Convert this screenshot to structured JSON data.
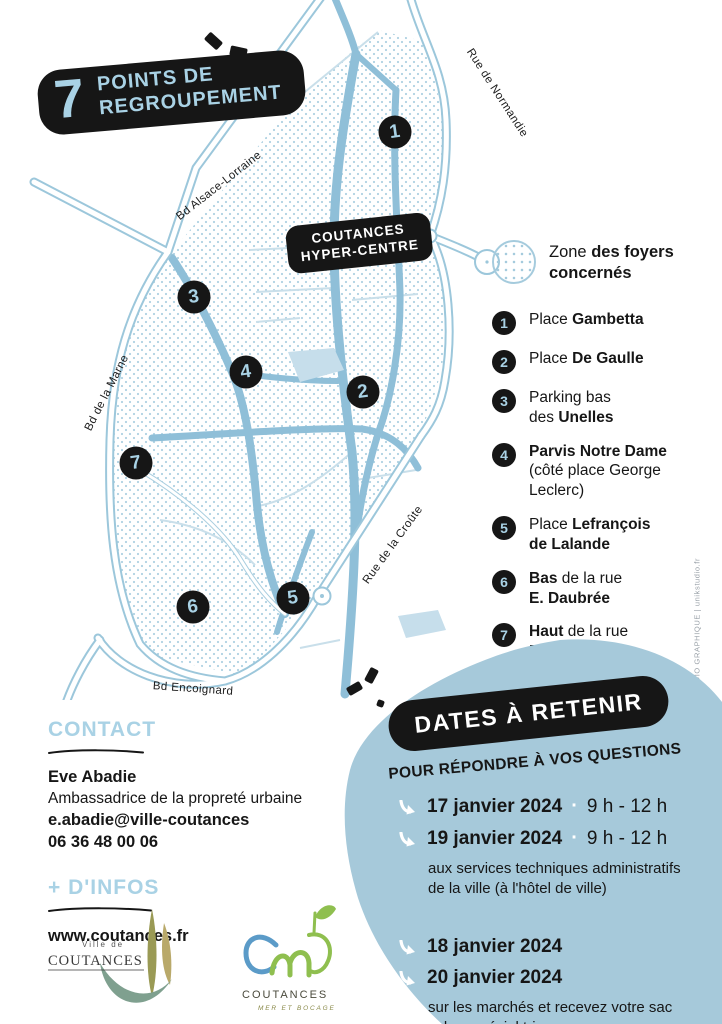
{
  "title": {
    "number": "7",
    "line1": "POINTS DE",
    "line2": "REGROUPEMENT"
  },
  "map": {
    "badge_line1": "COUTANCES",
    "badge_line2": "HYPER-CENTRE",
    "streets": [
      {
        "label": "Bd Alsace-Lorraine"
      },
      {
        "label": "Rue de Normandie"
      },
      {
        "label": "Bd de la Marne"
      },
      {
        "label": "Rue de la Croûte"
      },
      {
        "label": "Bd Encoignard"
      }
    ],
    "markers": [
      {
        "n": "1"
      },
      {
        "n": "2"
      },
      {
        "n": "3"
      },
      {
        "n": "4"
      },
      {
        "n": "5"
      },
      {
        "n": "6"
      },
      {
        "n": "7"
      }
    ]
  },
  "legend": {
    "zone_label": [
      {
        "t": "Zone "
      },
      {
        "t": "des foyers",
        "b": true
      },
      {
        "br": true
      },
      {
        "t": "concernés",
        "b": true
      }
    ],
    "items": [
      {
        "num": "1",
        "text": [
          {
            "t": "Place "
          },
          {
            "t": "Gambetta",
            "b": true
          }
        ]
      },
      {
        "num": "2",
        "text": [
          {
            "t": "Place "
          },
          {
            "t": "De Gaulle",
            "b": true
          }
        ]
      },
      {
        "num": "3",
        "text": [
          {
            "t": "Parking bas"
          },
          {
            "br": true
          },
          {
            "t": "des "
          },
          {
            "t": "Unelles",
            "b": true
          }
        ]
      },
      {
        "num": "4",
        "text": [
          {
            "t": "Parvis Notre Dame",
            "b": true
          },
          {
            "br": true
          },
          {
            "t": "(côté place George"
          },
          {
            "br": true
          },
          {
            "t": "Leclerc)"
          }
        ]
      },
      {
        "num": "5",
        "text": [
          {
            "t": "Place "
          },
          {
            "t": "Lefrançois",
            "b": true
          },
          {
            "br": true
          },
          {
            "t": "de Lalande",
            "b": true
          }
        ]
      },
      {
        "num": "6",
        "text": [
          {
            "t": "Bas",
            "b": true
          },
          {
            "t": " de la rue"
          },
          {
            "br": true
          },
          {
            "t": "E. Daubrée",
            "b": true
          }
        ]
      },
      {
        "num": "7",
        "text": [
          {
            "t": "Haut",
            "b": true
          },
          {
            "t": " de la rue"
          },
          {
            "br": true
          },
          {
            "t": "E. Daubrée",
            "b": true
          }
        ]
      }
    ]
  },
  "dates": {
    "badge": "DATES À RETENIR",
    "subtitle": "POUR RÉPONDRE À VOS QUESTIONS",
    "group1_rows": [
      {
        "date": "17 janvier 2024",
        "sep": "·",
        "time": "9 h - 12 h"
      },
      {
        "date": "19 janvier 2024",
        "sep": "·",
        "time": "9 h - 12 h"
      }
    ],
    "group1_note1": "aux services techniques administratifs",
    "group1_note2": "de la ville (à l'hôtel de ville)",
    "group2_rows": [
      {
        "date": "18 janvier 2024"
      },
      {
        "date": "20 janvier 2024"
      }
    ],
    "group2_note1": "sur les marchés et recevez votre sac",
    "group2_note2": "cabas spécial tri."
  },
  "contact": {
    "heading": "CONTACT",
    "name": "Eve Abadie",
    "role": "Ambassadrice de la propreté urbaine",
    "email": "e.abadie@ville-coutances",
    "phone": "06 36 48 00 06"
  },
  "infos": {
    "heading": "+ D'INFOS",
    "url": "www.coutances.fr"
  },
  "logos": {
    "ville_top": "Ville de",
    "ville_name": "COUTANCES",
    "cmb_name": "COUTANCES",
    "cmb_tagline": "MER ET BOCAGE"
  },
  "credit": "UNIK STUDIO GRAPHIQUE  |  unikstudio.fr",
  "colors": {
    "accent": "#a9d2e5",
    "road": "#8fbfd8",
    "blob": "#a6c9da",
    "ink": "#161616"
  }
}
